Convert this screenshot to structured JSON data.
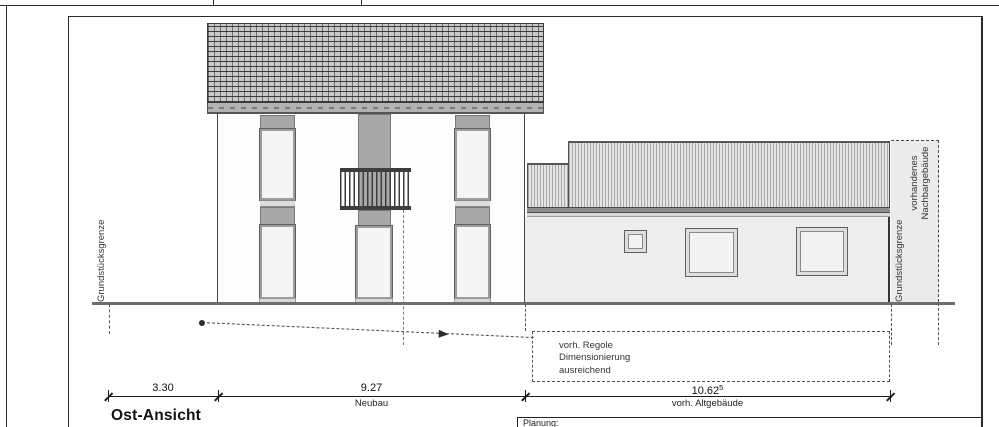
{
  "drawing": {
    "title": "Ost-Ansicht",
    "boundary_left_label": "Grundstücksgrenze",
    "boundary_right_label": "Grundstücksgrenze",
    "neighbor": {
      "line1": "vorhandenes",
      "line2": "Nachbargebäude"
    },
    "note": {
      "line1": "vorh. Regole",
      "line2": "Dimensionierung",
      "line3": "ausreichend"
    },
    "dimensions": {
      "d1": {
        "value": "3.30"
      },
      "d2": {
        "value": "9.27",
        "label": "Neubau"
      },
      "d3": {
        "value": "10.62",
        "sup": "5",
        "label": "vorh. Altgebäude"
      }
    },
    "titleblock": {
      "planung_label": "Planung:"
    },
    "colors": {
      "line": "#2b2b2b",
      "panel_gray": "#a8a8a8",
      "eaves_gray": "#b2b2b2",
      "old_wall_gray": "#ededed",
      "window_fill": "#f5f5f5",
      "ground_gray": "#6e6e6e"
    }
  }
}
